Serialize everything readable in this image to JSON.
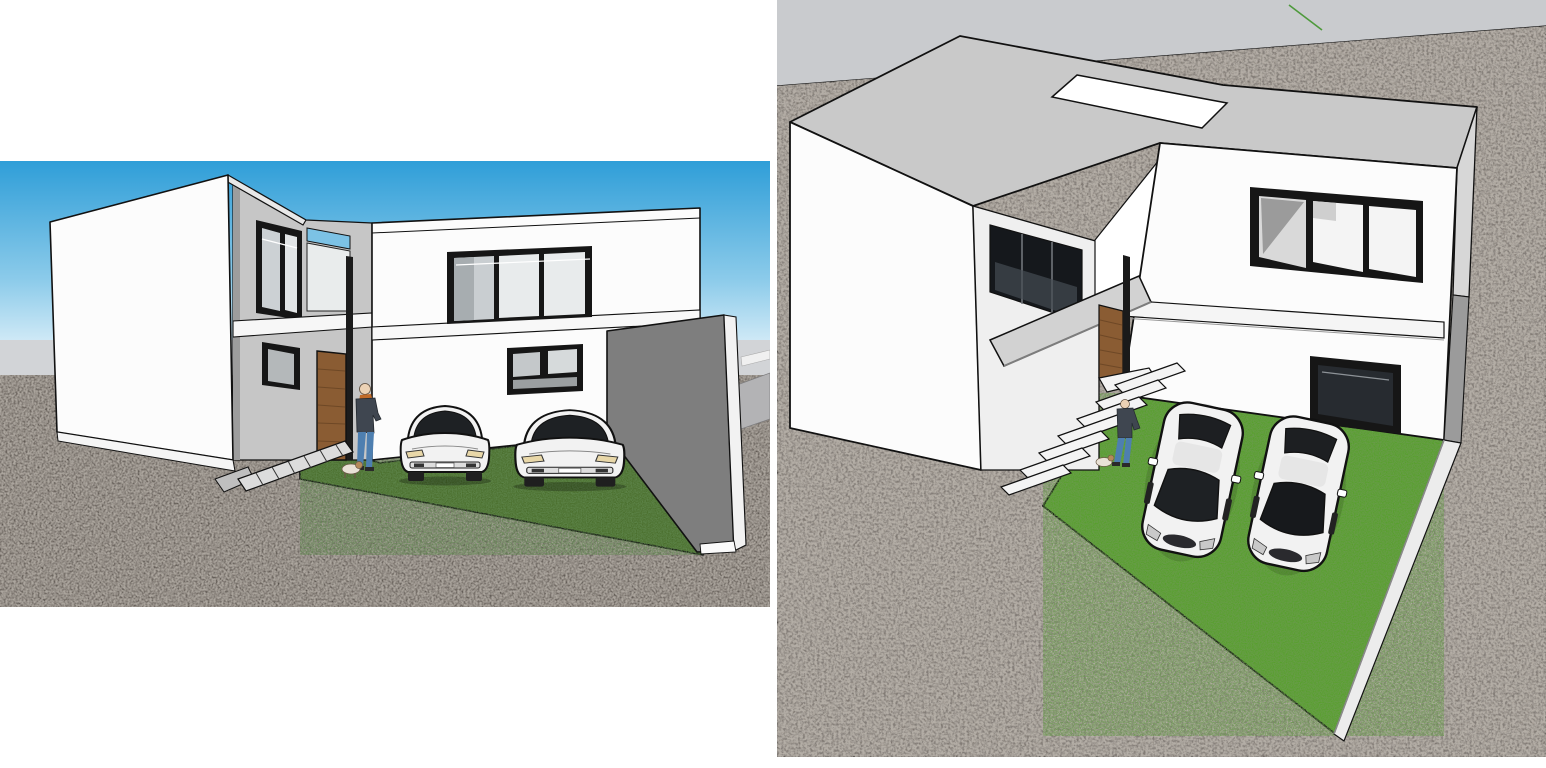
{
  "document": {
    "background": "#ffffff",
    "content": "two 3D model renders of a modern two-story house"
  },
  "colors": {
    "sky_top": "#2f9ed8",
    "sky_mid": "#8ccbea",
    "sky_horizon": "#dff0f9",
    "horizon_band": "#d2d4d7",
    "overcast_band": "#c9cbce",
    "ground_left": "#4b4540",
    "ground_right": "#79716a",
    "road_strip": "#b3b3b5",
    "lawn_left": "#4a6e2c",
    "lawn_right": "#57a02c",
    "wall_white": "#fcfcfc",
    "wall_shade": "#ececec",
    "recess_gray": "#c6c6c6",
    "roof_gray": "#c9c9c9",
    "boundary_wall_gray": "#7e7e7e",
    "boundary_wall_light": "#ececec",
    "window_frame": "#161616",
    "glass_light": "#e8ebec",
    "glass_mid": "#c9ced1",
    "glass_dark": "#22262b",
    "glass_blue": "#7cc2e5",
    "door_wood": "#8a5c33",
    "door_wood_dark": "#6e4826",
    "car_body": "#f2f2f2",
    "car_glass": "#1e2124",
    "stone_light": "#dcdcdc",
    "canopy_gray": "#d2d2d2",
    "person_jacket": "#3f4650",
    "person_jeans": "#4e7fb0",
    "person_skin": "#ecd2b5",
    "scarf_orange": "#c06a28",
    "dog_body": "#e9e2d6",
    "axis_green": "#4e9a3c",
    "outline": "#111111"
  },
  "panels": {
    "left": {
      "label": "street-level exterior render",
      "x": 0,
      "y": 161,
      "width": 770,
      "height": 446,
      "scene": {
        "sky": "blue gradient sky",
        "ground": "dark gravel ground",
        "house": "white two-story modern house with flat roof",
        "entry": "recessed entry with wood door and glazing",
        "lawn": "green courtyard lawn",
        "vehicles": [
          "white sedan",
          "white sedan"
        ],
        "figures": [
          "person leaning by door",
          "small dog"
        ],
        "wall": "gray boundary wall on right",
        "path": "stone steps to entry"
      }
    },
    "right": {
      "label": "aerial cutaway render",
      "x": 777,
      "y": 0,
      "width": 769,
      "height": 757,
      "scene": {
        "sky": "pale gray horizon band",
        "ground": "gravel terrain",
        "house": "same house viewed from above with flat gray roof and skylight",
        "entry": "entry canopy, wood door and stair slabs",
        "lawn": "bright green courtyard lawn",
        "vehicles": [
          "white sedan",
          "white sedan"
        ],
        "figures": [
          "person",
          "small dog"
        ],
        "wall": "thin boundary wall tapering to a point",
        "axis": "green model axis line"
      }
    }
  }
}
